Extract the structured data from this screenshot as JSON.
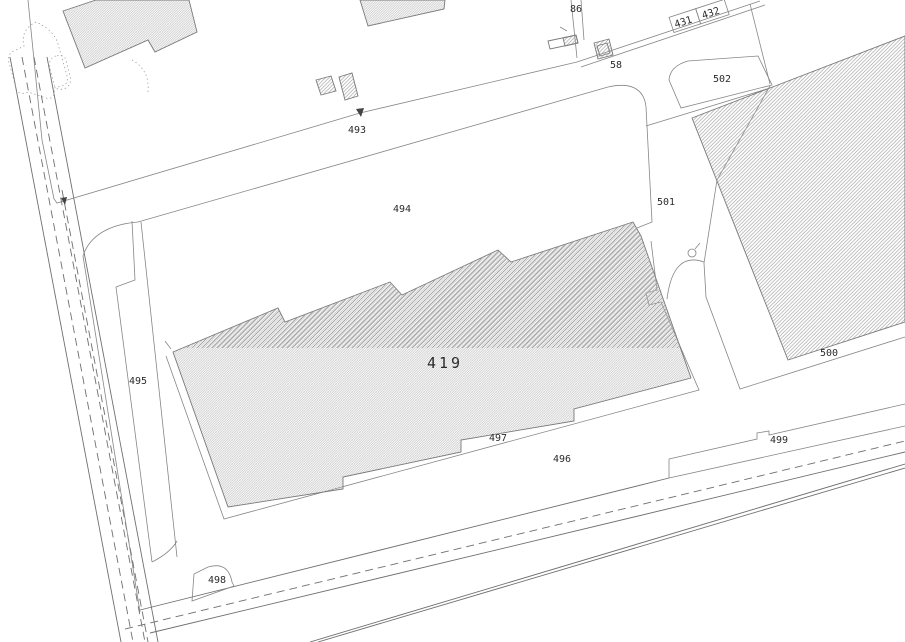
{
  "map": {
    "title": "cadastral-site-plan",
    "colors": {
      "background": "#ffffff",
      "line": "#6f6f6f",
      "parcel_line": "#868686",
      "hatch": "#a8a8a8",
      "label": "#2b2b2b"
    },
    "parcel_labels": {
      "p86": {
        "text": "86"
      },
      "p431": {
        "text": "431"
      },
      "p432": {
        "text": "432"
      },
      "p58": {
        "text": "58"
      },
      "p502": {
        "text": "502"
      },
      "p493": {
        "text": "493"
      },
      "p494": {
        "text": "494"
      },
      "p501": {
        "text": "501"
      },
      "p419": {
        "text": "419"
      },
      "p495": {
        "text": "495"
      },
      "p497": {
        "text": "497"
      },
      "p496": {
        "text": "496"
      },
      "p499": {
        "text": "499"
      },
      "p500": {
        "text": "500"
      },
      "p498": {
        "text": "498"
      }
    }
  }
}
